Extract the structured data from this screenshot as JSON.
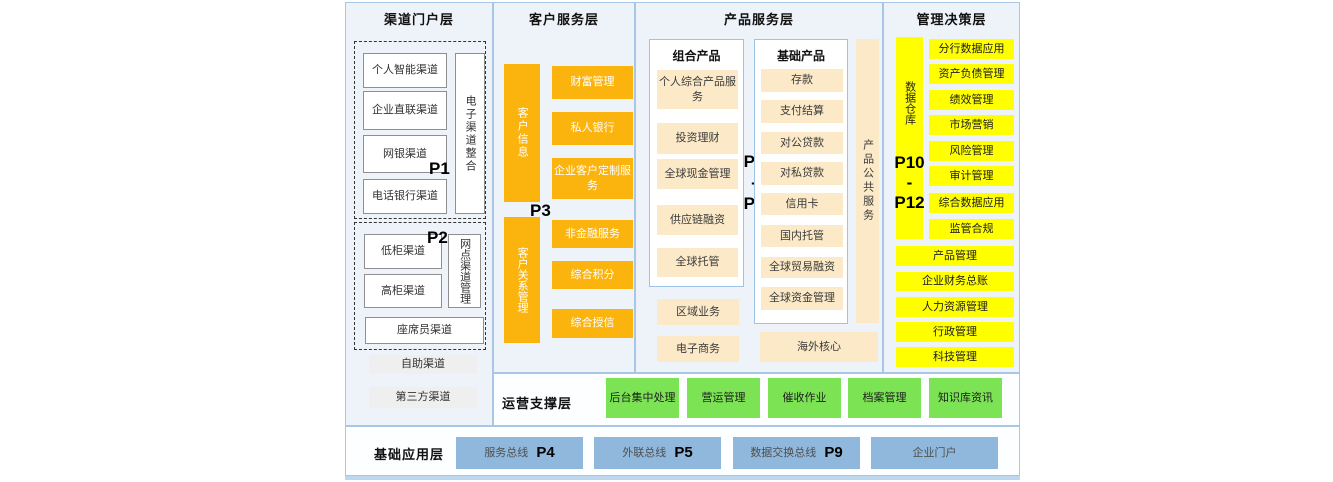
{
  "colors": {
    "orange": "#fbb30d",
    "cream": "#fbe9c7",
    "yellow": "#ffff00",
    "green": "#7ce355",
    "blue": "#8fb8dc",
    "column_bg": "#eef3fa",
    "row_bg": "#fdfeff",
    "border": "#a8c6e6",
    "strip": "#bdd7ee"
  },
  "layers": {
    "channel": {
      "title": "渠道门户层",
      "p1_label": "P1",
      "p1_items": [
        "个人智能渠道",
        "企业直联渠道",
        "网银渠道",
        "电话银行渠道"
      ],
      "p1_vertical": "电子渠道整合",
      "p2_label": "P2",
      "p2_items": [
        "低柜渠道",
        "高柜渠道"
      ],
      "p2_vertical": "网点渠道管理",
      "p2_wide": "座席员渠道",
      "extra_items": [
        "自助渠道",
        "第三方渠道"
      ]
    },
    "customer": {
      "title": "客户服务层",
      "bar_top": "客户信息",
      "p3_label": "P3",
      "bar_bottom": "客户关系管理",
      "items": [
        "财富管理",
        "私人银行",
        "企业客户定制服务",
        "非金融服务",
        "综合积分",
        "综合授信"
      ]
    },
    "product": {
      "title": "产品服务层",
      "combo_title": "组合产品",
      "combo_items": [
        "个人综合产品服务",
        "投资理财",
        "全球现金管理",
        "供应链融资",
        "全球托管"
      ],
      "combo_extra": [
        "区域业务",
        "电子商务"
      ],
      "basic_title": "基础产品",
      "basic_items": [
        "存款",
        "支付结算",
        "对公贷款",
        "对私贷款",
        "信用卡",
        "国内托管",
        "全球贸易融资",
        "全球资金管理"
      ],
      "basic_extra": "海外核心",
      "vertical": "产品公共服务",
      "p_top": "P6",
      "p_mid": "-",
      "p_bottom": "P8"
    },
    "management": {
      "title": "管理决策层",
      "vertical": "数据仓库",
      "p_top": "P10",
      "p_mid": "-",
      "p_bottom": "P12",
      "items": [
        "分行数据应用",
        "资产负债管理",
        "绩效管理",
        "市场营销",
        "风险管理",
        "审计管理",
        "综合数据应用",
        "监管合规"
      ],
      "wide_items": [
        "产品管理",
        "企业财务总账",
        "人力资源管理",
        "行政管理",
        "科技管理"
      ]
    },
    "operations": {
      "title": "运营支撑层",
      "items": [
        "后台集中处理",
        "营运管理",
        "催收作业",
        "档案管理",
        "知识库资讯"
      ]
    },
    "foundation": {
      "title": "基础应用层",
      "buses": [
        {
          "label": "服务总线",
          "p": "P4"
        },
        {
          "label": "外联总线",
          "p": "P5"
        },
        {
          "label": "数据交换总线",
          "p": "P9"
        },
        {
          "label": "企业门户",
          "p": ""
        }
      ]
    }
  }
}
